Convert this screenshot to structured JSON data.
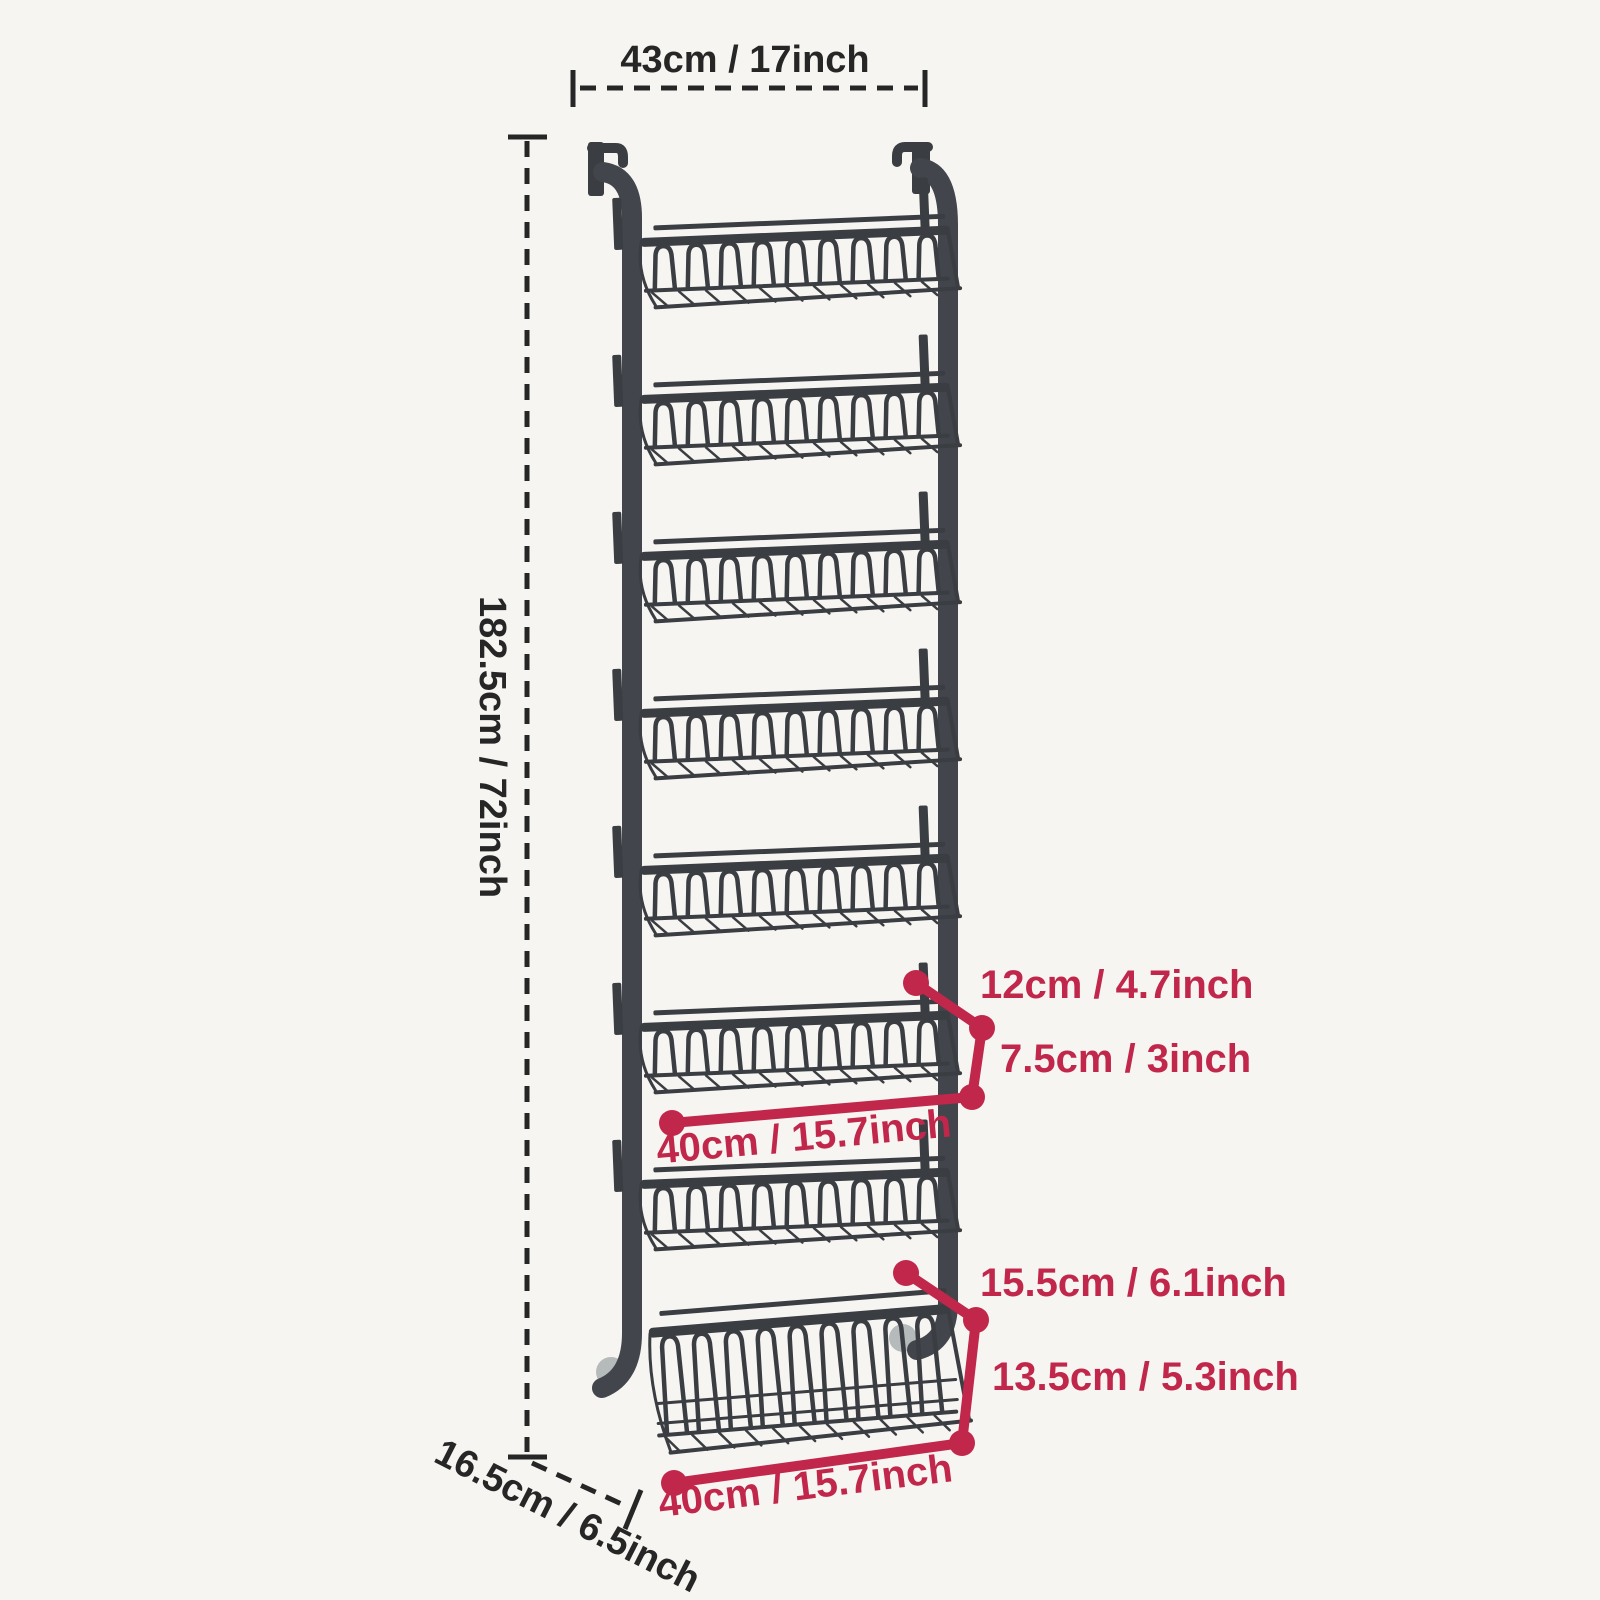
{
  "diagram": {
    "annotations": {
      "top_width": "43cm / 17inch",
      "total_height": "182.5cm / 72inch",
      "hook_depth": "16.5cm / 6.5inch",
      "tier_basket": {
        "depth": "12cm / 4.7inch",
        "height": "7.5cm / 3inch",
        "width": "40cm / 15.7inch"
      },
      "bottom_basket": {
        "depth": "15.5cm / 6.1inch",
        "height": "13.5cm / 5.3inch",
        "width": "40cm / 15.7inch"
      }
    },
    "rack": {
      "basket_tiers": 8,
      "small_baskets": 7,
      "deep_bottom_baskets": 1
    },
    "colors": {
      "background": "#f7f5f1",
      "rack": "#3a3d42",
      "dimension_text": "#262626",
      "accent_red": "#c0274a",
      "door_bumper_gray": "#b5babb"
    }
  }
}
